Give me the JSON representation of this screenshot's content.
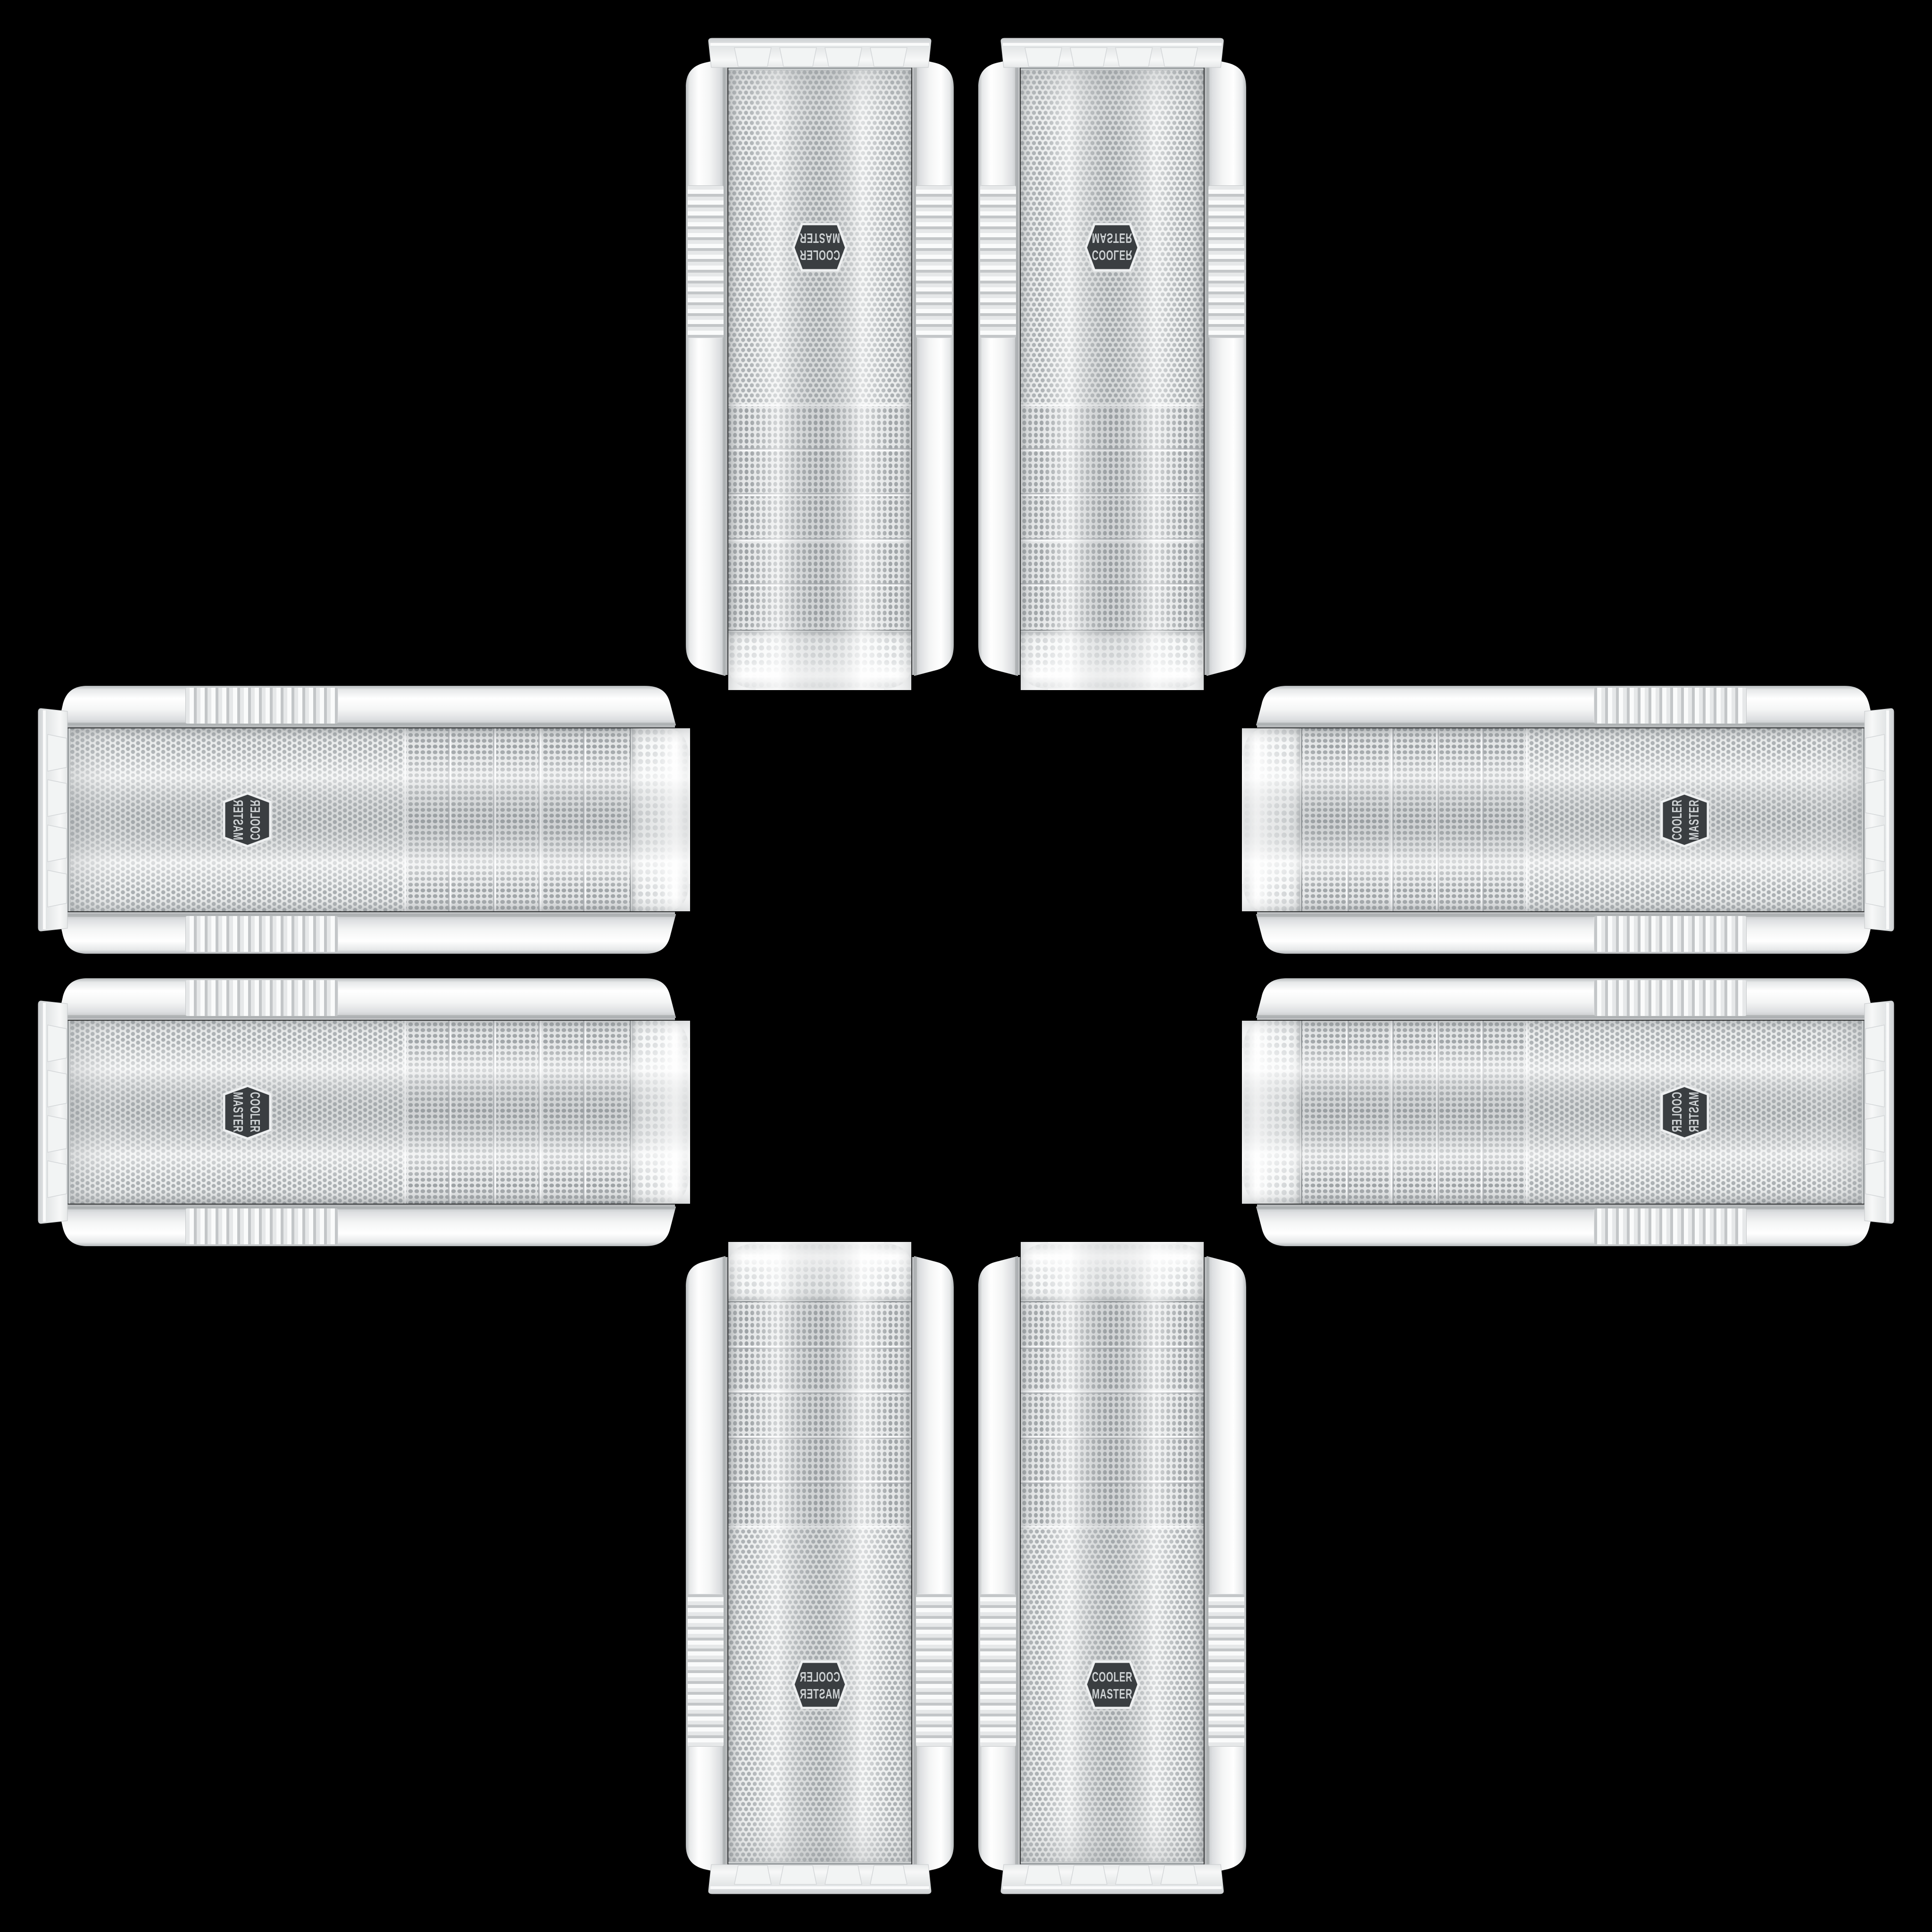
{
  "scene": {
    "title": "Eight white Cooler Master mesh-front tower cases arranged in a cross pattern on black",
    "background": "#000000",
    "case_count": 8,
    "brand": "Cooler Master"
  },
  "badge": {
    "line1": "COOLER",
    "line2": "MASTER",
    "badge_bg": "#3a3e41",
    "badge_text": "#ced2d4",
    "badge_border": "#eef0f1"
  },
  "case_style": {
    "body_white": "#f3f5f5",
    "mesh_background": "#e9ebec",
    "mesh_dot": "#a9aeb1",
    "bay_dot": "#9da2a5",
    "top_dot": "#c7cbcd",
    "chrome": "#8a8f92",
    "drive_bay_strips": 5
  },
  "cases": [
    {
      "id": "top-left",
      "orientation": "vertical, upside down, mirrored",
      "transform": "translate(2028,1475) scale(-1,-1)"
    },
    {
      "id": "top-right",
      "orientation": "vertical, upside down",
      "transform": "translate(2068,1475) scale(1,-1)"
    },
    {
      "id": "bottom-left",
      "orientation": "vertical, mirrored",
      "transform": "translate(2028,2621) scale(-1,1)"
    },
    {
      "id": "bottom-right",
      "orientation": "vertical, upright",
      "transform": "translate(2068,2621) scale(1,1)"
    },
    {
      "id": "left-top",
      "orientation": "horizontal, top toward center, flipped",
      "transform": "translate(1475,2028) scale(1,-1) rotate(90)"
    },
    {
      "id": "left-bottom",
      "orientation": "horizontal, top toward center",
      "transform": "translate(1475,2068) rotate(90)"
    },
    {
      "id": "right-top",
      "orientation": "horizontal, top toward center, flipped",
      "transform": "translate(2621,2028) scale(-1,-1) rotate(90)"
    },
    {
      "id": "right-bottom",
      "orientation": "horizontal, top toward center",
      "transform": "translate(2621,2068) scale(-1,1) rotate(90)"
    }
  ]
}
